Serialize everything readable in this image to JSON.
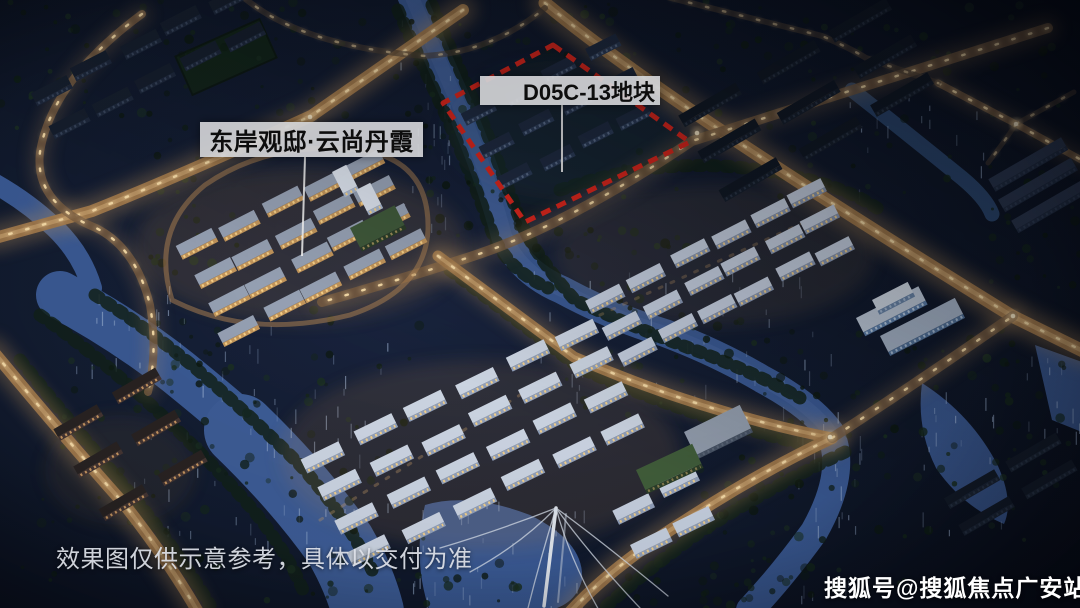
{
  "annotations": {
    "project_label": "东岸观邸·云尚丹霞",
    "parcel_label": "D05C-13地块",
    "parcel_outline_color": "#e0281e"
  },
  "footer": {
    "disclaimer": "效果图仅供示意参考，具体以交付为准",
    "watermark": "搜狐号@搜狐焦点广安站"
  },
  "palette": {
    "night_base": "#0d1424",
    "water": "#3c5c97",
    "road_light": "#d8a968",
    "tree": "#13221a",
    "label_bg": "#d1d2d5",
    "label_text": "#0d0d0d",
    "watermark_color": "#ffffff"
  }
}
